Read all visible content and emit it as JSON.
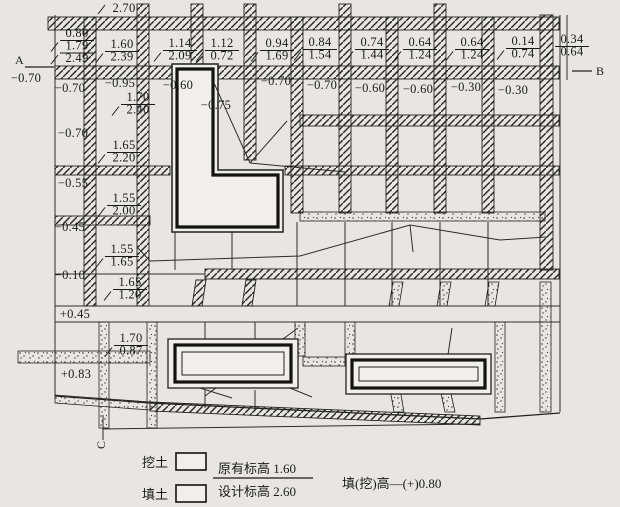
{
  "colors": {
    "paper": "#e9e6e1",
    "building_fill": "#f2efea",
    "ink": "#1b1b1b"
  },
  "markers": {
    "a": "A",
    "b": "B",
    "c": "C"
  },
  "legend": {
    "cut_label": "挖土",
    "fill_label": "填土",
    "original_elevation": "原有标高 1.60",
    "design_elevation": "设计标高 2.60",
    "formula": "填(挖)高—(+)0.80"
  },
  "plan": {
    "labels": [
      {
        "x": 77,
        "y": 37,
        "values": [
          "0.80",
          "1.79",
          "2.49"
        ]
      },
      {
        "x": 122,
        "y": 48,
        "values": [
          "1.60",
          "2.39"
        ]
      },
      {
        "x": 180,
        "y": 47,
        "values": [
          "1.14",
          "2.09"
        ]
      },
      {
        "x": 222,
        "y": 47,
        "values": [
          "1.12",
          "0.72"
        ]
      },
      {
        "x": 277,
        "y": 47,
        "values": [
          "0.94",
          "1.69"
        ]
      },
      {
        "x": 320,
        "y": 46,
        "values": [
          "0.84",
          "1.54"
        ]
      },
      {
        "x": 372,
        "y": 46,
        "values": [
          "0.74",
          "1.44"
        ]
      },
      {
        "x": 420,
        "y": 46,
        "values": [
          "0.64",
          "1.24"
        ]
      },
      {
        "x": 472,
        "y": 46,
        "values": [
          "0.64",
          "1.24"
        ]
      },
      {
        "x": 523,
        "y": 45,
        "values": [
          "0.14",
          "0.74"
        ]
      },
      {
        "x": 572,
        "y": 43,
        "values": [
          "0.34",
          "0.64"
        ]
      },
      {
        "x": 26,
        "y": 82,
        "values": [
          "−0.70"
        ]
      },
      {
        "x": 70,
        "y": 92,
        "values": [
          "−0.70"
        ]
      },
      {
        "x": 120,
        "y": 87,
        "values": [
          "−0.95"
        ]
      },
      {
        "x": 138,
        "y": 101,
        "values": [
          "1.70",
          "2.40"
        ]
      },
      {
        "x": 178,
        "y": 89,
        "values": [
          "−0.60"
        ]
      },
      {
        "x": 216,
        "y": 109,
        "values": [
          "−0.75"
        ]
      },
      {
        "x": 276,
        "y": 85,
        "values": [
          "−0.70"
        ]
      },
      {
        "x": 322,
        "y": 89,
        "values": [
          "−0.70"
        ]
      },
      {
        "x": 370,
        "y": 92,
        "values": [
          "−0.60"
        ]
      },
      {
        "x": 418,
        "y": 93,
        "values": [
          "−0.60"
        ]
      },
      {
        "x": 466,
        "y": 91,
        "values": [
          "−0.30"
        ]
      },
      {
        "x": 513,
        "y": 94,
        "values": [
          "−0.30"
        ]
      },
      {
        "x": 73,
        "y": 137,
        "values": [
          "−0.70"
        ]
      },
      {
        "x": 124,
        "y": 149,
        "values": [
          "1.65",
          "2.20"
        ]
      },
      {
        "x": 73,
        "y": 187,
        "values": [
          "−0.55"
        ]
      },
      {
        "x": 124,
        "y": 202,
        "values": [
          "1.55",
          "2.00"
        ]
      },
      {
        "x": 70,
        "y": 231,
        "values": [
          "−0.45"
        ]
      },
      {
        "x": 122,
        "y": 253,
        "values": [
          "1.55",
          "1.65"
        ]
      },
      {
        "x": 70,
        "y": 279,
        "values": [
          "−0.10"
        ]
      },
      {
        "x": 130,
        "y": 286,
        "values": [
          "1.65",
          "1.20"
        ]
      },
      {
        "x": 75,
        "y": 318,
        "values": [
          "+0.45"
        ]
      },
      {
        "x": 131,
        "y": 342,
        "values": [
          "1.70",
          "0.87"
        ]
      },
      {
        "x": 76,
        "y": 378,
        "values": [
          "+0.83"
        ]
      },
      {
        "x": 124,
        "y": 12,
        "values": [
          "2.70"
        ],
        "slash": true
      }
    ]
  }
}
